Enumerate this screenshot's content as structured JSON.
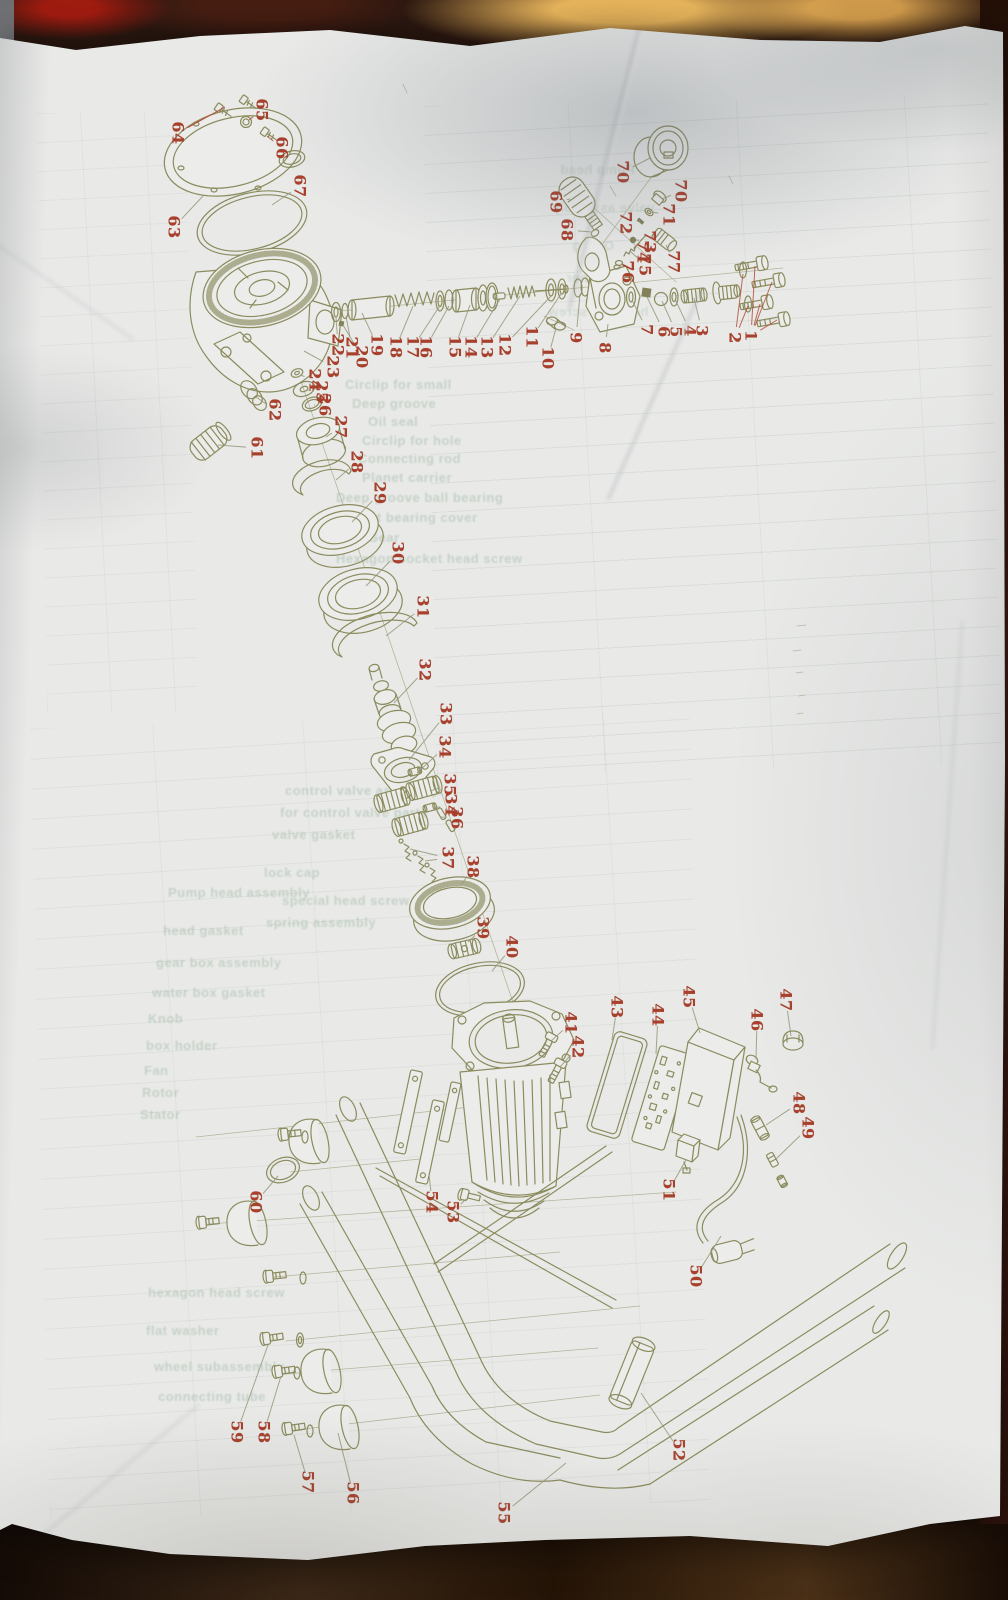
{
  "scene": {
    "description": "Photograph of a crumpled printed sheet showing an exploded parts diagram of a pressure-washer pump, motor and frame, with red part numbers and a parts table showing through from the reverse side",
    "paper_color": "#e9eae8",
    "line_color": "#8b8b5e",
    "label_color": "#a8402c",
    "leader_color": "#97977a",
    "red_leader_color": "#b2503a",
    "background_colors": {
      "top_red": "#9e1b10",
      "top_orange": "#e8b55c",
      "bottom_brown": "#3c2817",
      "right_maroon": "#3f1d15",
      "left_gray": "#8e9094"
    }
  },
  "labels": [
    {
      "n": "64",
      "x": 178,
      "y": 133,
      "t": [
        [
          210,
          115
        ],
        [
          225,
          107
        ]
      ],
      "red": true
    },
    {
      "n": "65",
      "x": 262,
      "y": 110,
      "t": [
        [
          249,
          120
        ]
      ],
      "red": true
    },
    {
      "n": "66",
      "x": 282,
      "y": 148,
      "t": [
        [
          267,
          136
        ]
      ],
      "red": true
    },
    {
      "n": "67",
      "x": 300,
      "y": 186,
      "t": [
        [
          272,
          205
        ]
      ]
    },
    {
      "n": "63",
      "x": 174,
      "y": 227,
      "t": [
        [
          203,
          196
        ]
      ]
    },
    {
      "n": "22",
      "x": 338,
      "y": 345,
      "t": [
        [
          336,
          317
        ]
      ]
    },
    {
      "n": "21",
      "x": 352,
      "y": 348,
      "t": [
        [
          346,
          316
        ]
      ]
    },
    {
      "n": "20",
      "x": 362,
      "y": 357,
      "t": [
        [
          343,
          325
        ]
      ]
    },
    {
      "n": "19",
      "x": 377,
      "y": 345,
      "t": [
        [
          362,
          313
        ]
      ]
    },
    {
      "n": "18",
      "x": 396,
      "y": 347,
      "t": [
        [
          413,
          306
        ]
      ]
    },
    {
      "n": "17",
      "x": 413,
      "y": 347,
      "t": [
        [
          439,
          307
        ]
      ]
    },
    {
      "n": "16",
      "x": 426,
      "y": 347,
      "t": [
        [
          449,
          306
        ]
      ]
    },
    {
      "n": "15",
      "x": 455,
      "y": 347,
      "t": [
        [
          470,
          305
        ]
      ]
    },
    {
      "n": "14",
      "x": 471,
      "y": 347,
      "t": [
        [
          500,
          299
        ]
      ]
    },
    {
      "n": "13",
      "x": 487,
      "y": 347,
      "t": [
        [
          520,
          296
        ]
      ]
    },
    {
      "n": "12",
      "x": 505,
      "y": 345,
      "t": [
        [
          551,
          296
        ]
      ]
    },
    {
      "n": "11",
      "x": 532,
      "y": 337,
      "t": [
        [
          561,
          294
        ]
      ]
    },
    {
      "n": "10",
      "x": 548,
      "y": 358,
      "t": [
        [
          556,
          328
        ]
      ]
    },
    {
      "n": "9",
      "x": 576,
      "y": 338,
      "t": [
        [
          580,
          294
        ]
      ]
    },
    {
      "n": "8",
      "x": 605,
      "y": 348,
      "t": [
        [
          608,
          324
        ]
      ]
    },
    {
      "n": "23",
      "x": 333,
      "y": 367,
      "t": [
        [
          304,
          351
        ]
      ]
    },
    {
      "n": "24",
      "x": 315,
      "y": 380,
      "t": [
        [
          300,
          375
        ]
      ]
    },
    {
      "n": "25",
      "x": 322,
      "y": 392,
      "t": [
        [
          307,
          390
        ]
      ]
    },
    {
      "n": "26",
      "x": 325,
      "y": 405,
      "t": [
        [
          315,
          405
        ]
      ]
    },
    {
      "n": "27",
      "x": 341,
      "y": 427,
      "t": [
        [
          326,
          437
        ]
      ]
    },
    {
      "n": "28",
      "x": 357,
      "y": 462,
      "t": [
        [
          336,
          480
        ]
      ]
    },
    {
      "n": "29",
      "x": 380,
      "y": 493,
      "t": [
        [
          352,
          522
        ]
      ]
    },
    {
      "n": "30",
      "x": 398,
      "y": 553,
      "t": [
        [
          366,
          586
        ]
      ]
    },
    {
      "n": "31",
      "x": 423,
      "y": 607,
      "t": [
        [
          386,
          636
        ]
      ]
    },
    {
      "n": "32",
      "x": 425,
      "y": 670,
      "t": [
        [
          394,
          703
        ]
      ]
    },
    {
      "n": "33",
      "x": 446,
      "y": 714,
      "t": [
        [
          409,
          760
        ]
      ]
    },
    {
      "n": "34",
      "x": 445,
      "y": 747,
      "t": [
        [
          417,
          773
        ]
      ]
    },
    {
      "n": "35",
      "x": 450,
      "y": 785,
      "t": [
        [
          430,
          791
        ]
      ]
    },
    {
      "n": "34",
      "x": 451,
      "y": 805,
      "t": [
        [
          433,
          808
        ]
      ]
    },
    {
      "n": "36",
      "x": 457,
      "y": 818,
      "t": [
        [
          441,
          817
        ]
      ]
    },
    {
      "n": "37",
      "x": 448,
      "y": 858,
      "t": [
        [
          410,
          849
        ],
        [
          425,
          861
        ]
      ]
    },
    {
      "n": "38",
      "x": 473,
      "y": 867,
      "t": [
        [
          462,
          884
        ]
      ]
    },
    {
      "n": "39",
      "x": 483,
      "y": 928,
      "t": [
        [
          468,
          942
        ]
      ]
    },
    {
      "n": "40",
      "x": 512,
      "y": 947,
      "t": [
        [
          492,
          971
        ]
      ]
    },
    {
      "n": "62",
      "x": 275,
      "y": 410,
      "t": [
        [
          256,
          397
        ]
      ]
    },
    {
      "n": "61",
      "x": 257,
      "y": 448,
      "t": [
        [
          218,
          445
        ]
      ]
    },
    {
      "n": "70",
      "x": 623,
      "y": 172,
      "t": [
        [
          650,
          158
        ]
      ]
    },
    {
      "n": "69",
      "x": 556,
      "y": 202,
      "t": [
        [
          570,
          199
        ]
      ]
    },
    {
      "n": "68",
      "x": 567,
      "y": 230,
      "t": [
        [
          592,
          232
        ]
      ]
    },
    {
      "n": "72",
      "x": 626,
      "y": 223,
      "t": [
        [
          640,
          221
        ]
      ]
    },
    {
      "n": "71",
      "x": 669,
      "y": 215,
      "t": [
        [
          652,
          212
        ]
      ]
    },
    {
      "n": "70",
      "x": 681,
      "y": 191,
      "t": [
        [
          662,
          199
        ]
      ]
    },
    {
      "n": "73",
      "x": 650,
      "y": 242,
      "t": [
        [
          636,
          240
        ]
      ]
    },
    {
      "n": "74",
      "x": 643,
      "y": 252,
      "t": [
        [
          640,
          244
        ]
      ]
    },
    {
      "n": "75",
      "x": 645,
      "y": 265,
      "t": [
        [
          630,
          251
        ]
      ]
    },
    {
      "n": "76",
      "x": 628,
      "y": 272,
      "t": [
        [
          621,
          263
        ]
      ]
    },
    {
      "n": "77",
      "x": 674,
      "y": 262,
      "t": [
        [
          666,
          245
        ]
      ]
    },
    {
      "n": "7",
      "x": 647,
      "y": 330,
      "t": [
        [
          632,
          300
        ]
      ]
    },
    {
      "n": "6",
      "x": 664,
      "y": 332,
      "t": [
        [
          647,
          297
        ]
      ]
    },
    {
      "n": "5",
      "x": 676,
      "y": 332,
      "t": [
        [
          662,
          301
        ]
      ]
    },
    {
      "n": "4",
      "x": 690,
      "y": 331,
      "t": [
        [
          675,
          299
        ]
      ]
    },
    {
      "n": "3",
      "x": 702,
      "y": 331,
      "t": [
        [
          694,
          298
        ]
      ]
    },
    {
      "n": "2",
      "x": 735,
      "y": 338,
      "t": [
        [
          743,
          274
        ],
        [
          748,
          306
        ]
      ],
      "red": true
    },
    {
      "n": "1",
      "x": 751,
      "y": 336,
      "t": [
        [
          755,
          266
        ],
        [
          772,
          282
        ],
        [
          760,
          304
        ],
        [
          777,
          320
        ]
      ],
      "red": true
    },
    {
      "n": "41",
      "x": 571,
      "y": 1023,
      "t": [
        [
          551,
          1041
        ]
      ]
    },
    {
      "n": "42",
      "x": 578,
      "y": 1047,
      "t": [
        [
          560,
          1067
        ]
      ]
    },
    {
      "n": "43",
      "x": 617,
      "y": 1007,
      "t": [
        [
          612,
          1040
        ]
      ]
    },
    {
      "n": "44",
      "x": 658,
      "y": 1015,
      "t": [
        [
          656,
          1054
        ]
      ]
    },
    {
      "n": "45",
      "x": 689,
      "y": 997,
      "t": [
        [
          700,
          1033
        ]
      ]
    },
    {
      "n": "46",
      "x": 757,
      "y": 1020,
      "t": [
        [
          756,
          1059
        ]
      ]
    },
    {
      "n": "47",
      "x": 786,
      "y": 1000,
      "t": [
        [
          791,
          1036
        ]
      ]
    },
    {
      "n": "48",
      "x": 799,
      "y": 1103,
      "t": [
        [
          766,
          1125
        ]
      ]
    },
    {
      "n": "49",
      "x": 808,
      "y": 1128,
      "t": [
        [
          776,
          1159
        ]
      ]
    },
    {
      "n": "51",
      "x": 669,
      "y": 1190,
      "t": [
        [
          686,
          1160
        ]
      ]
    },
    {
      "n": "50",
      "x": 696,
      "y": 1276,
      "t": [
        [
          721,
          1236
        ]
      ]
    },
    {
      "n": "52",
      "x": 679,
      "y": 1450,
      "t": [
        [
          641,
          1393
        ]
      ]
    },
    {
      "n": "53",
      "x": 453,
      "y": 1212,
      "t": [
        [
          466,
          1199
        ]
      ]
    },
    {
      "n": "54",
      "x": 432,
      "y": 1202,
      "t": [
        [
          429,
          1174
        ]
      ]
    },
    {
      "n": "60",
      "x": 256,
      "y": 1202,
      "t": [
        [
          278,
          1176
        ]
      ]
    },
    {
      "n": "59",
      "x": 237,
      "y": 1432,
      "t": [
        [
          268,
          1345
        ]
      ]
    },
    {
      "n": "58",
      "x": 264,
      "y": 1432,
      "t": [
        [
          281,
          1376
        ]
      ]
    },
    {
      "n": "57",
      "x": 308,
      "y": 1482,
      "t": [
        [
          294,
          1435
        ]
      ]
    },
    {
      "n": "56",
      "x": 353,
      "y": 1493,
      "t": [
        [
          338,
          1433
        ]
      ]
    },
    {
      "n": "55",
      "x": 504,
      "y": 1513,
      "t": [
        [
          566,
          1463
        ]
      ]
    }
  ],
  "bleed_rows": [
    {
      "text": "Pump head",
      "x": 560,
      "y": 162,
      "m": true
    },
    {
      "text": "valve assembly",
      "x": 552,
      "y": 200,
      "m": true
    },
    {
      "text": "O-ring",
      "x": 572,
      "y": 238,
      "m": true
    },
    {
      "text": "washer",
      "x": 566,
      "y": 270,
      "m": true
    },
    {
      "text": "hexagon screw",
      "x": 548,
      "y": 304,
      "m": true
    },
    {
      "text": "Circlip for small",
      "x": 345,
      "y": 377
    },
    {
      "text": "Deep groove",
      "x": 352,
      "y": 396
    },
    {
      "text": "Oil seal",
      "x": 368,
      "y": 414
    },
    {
      "text": "Circlip for hole",
      "x": 362,
      "y": 433
    },
    {
      "text": "Connecting rod",
      "x": 358,
      "y": 451
    },
    {
      "text": "Planet carrier",
      "x": 362,
      "y": 470
    },
    {
      "text": "Deep groove ball bearing",
      "x": 336,
      "y": 490
    },
    {
      "text": "Front bearing cover",
      "x": 346,
      "y": 510
    },
    {
      "text": "Gear",
      "x": 368,
      "y": 530
    },
    {
      "text": "Hexagon socket head screw",
      "x": 336,
      "y": 551
    },
    {
      "text": "control valve assembly",
      "x": 285,
      "y": 783
    },
    {
      "text": "for control valve parts",
      "x": 280,
      "y": 805
    },
    {
      "text": "valve gasket",
      "x": 272,
      "y": 827
    },
    {
      "text": "lock cap",
      "x": 264,
      "y": 865
    },
    {
      "text": "special head screw",
      "x": 282,
      "y": 893
    },
    {
      "text": "spring assembly",
      "x": 266,
      "y": 915
    },
    {
      "text": "Pump head assembly",
      "x": 168,
      "y": 885
    },
    {
      "text": "head gasket",
      "x": 163,
      "y": 923
    },
    {
      "text": "gear box assembly",
      "x": 156,
      "y": 955
    },
    {
      "text": "water box gasket",
      "x": 152,
      "y": 985
    },
    {
      "text": "Knob",
      "x": 148,
      "y": 1011
    },
    {
      "text": "box holder",
      "x": 146,
      "y": 1038
    },
    {
      "text": "Fan",
      "x": 144,
      "y": 1063
    },
    {
      "text": "Rotor",
      "x": 142,
      "y": 1085
    },
    {
      "text": "Stator",
      "x": 140,
      "y": 1107
    },
    {
      "text": "hexagon head screw",
      "x": 148,
      "y": 1285
    },
    {
      "text": "flat washer",
      "x": 146,
      "y": 1323
    },
    {
      "text": "wheel subassembly",
      "x": 154,
      "y": 1359
    },
    {
      "text": "connecting tube",
      "x": 158,
      "y": 1389
    }
  ]
}
